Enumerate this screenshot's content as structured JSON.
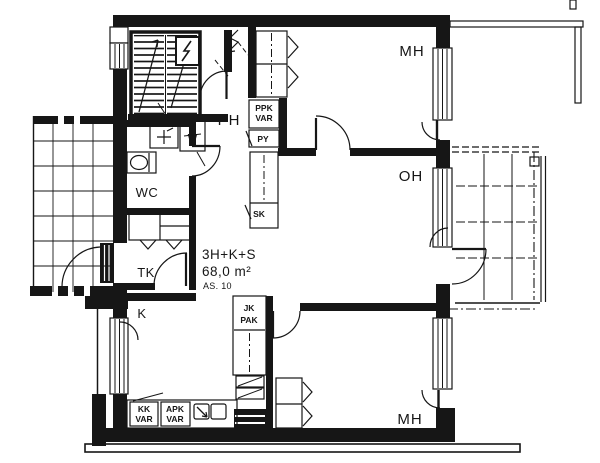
{
  "plan": {
    "apartment": {
      "type_label": "3H+K+S",
      "area_label": "68,0 m²",
      "unit_label": "AS. 10"
    },
    "rooms": {
      "mh_top": "MH",
      "oh": "OH",
      "ph": "PH",
      "wc": "WC",
      "tk": "TK",
      "k": "K",
      "mh_bottom": "MH"
    },
    "closets": {
      "ppk_line1": "PPK",
      "ppk_line2": "VAR",
      "py": "PY",
      "sk": "SK",
      "jk_line1": "JK",
      "jk_line2": "PAK",
      "kk_line1": "KK",
      "kk_line2": "VAR",
      "apk_line1": "APK",
      "apk_line2": "VAR"
    },
    "fixtures": {
      "w_mark": "W"
    },
    "colors": {
      "ink": "#161616",
      "paper": "#ffffff"
    }
  }
}
